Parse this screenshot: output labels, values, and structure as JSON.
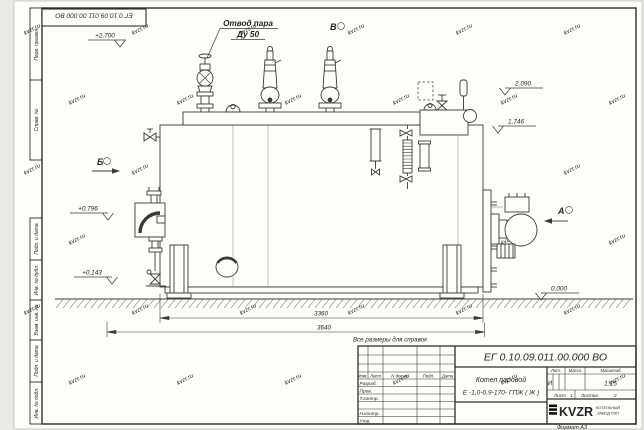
{
  "watermark": "kvzr.ru",
  "frame": {
    "stamp_top_left": "ЕГ 0.10.09.011.00.000  ВО",
    "margin_cells": [
      "Перв. примен.",
      "Справ. №",
      "Подп. и дата",
      "Инв. № дубл.",
      "Взам. инв. №",
      "Подп. и дата",
      "Инв. № подл."
    ],
    "format_note": "Формат А3"
  },
  "drawing": {
    "callout": {
      "line1": "Отвод пара",
      "line2": "Ду 50"
    },
    "views": {
      "a": "А",
      "b": "Б",
      "v": "В"
    },
    "elevations": {
      "e2700": "+2,700",
      "e2090": "2,090",
      "e1746": "1,746",
      "e0796": "+0,796",
      "e0143": "+0,143",
      "e0000": "0,000"
    },
    "dimensions": {
      "length_body": "3360",
      "length_total": "3640"
    },
    "note": "Все размеры для справок"
  },
  "title_block": {
    "doc_number": "ЕГ 0.10.09.011.00.000  ВО",
    "name_line1": "Котел паровой",
    "name_line2": "Е -1,0-0,9-170- ГПЖ ( Ж )",
    "columns": {
      "izm": "Изм.",
      "list": "Лист",
      "doc": "N докум.",
      "podp": "Подп.",
      "data": "Дата"
    },
    "rows": {
      "razrab": "Разраб.",
      "prov": "Пров.",
      "tkontr": "Т.контр.",
      "nkontr": "Н.контр.",
      "utv": "Утв."
    },
    "props": {
      "lit_label": "Лит.",
      "mass_label": "Масса",
      "scale_label": "Масштаб",
      "lit": "И",
      "scale": "1:15",
      "sheet_label": "Лист",
      "sheet": "1",
      "sheets_label": "Листов",
      "sheets": "2"
    },
    "company": {
      "logo": "KVZR",
      "line1": "КОТЕЛЬНЫЙ",
      "line2": "ЗАВОД РЭП"
    }
  }
}
